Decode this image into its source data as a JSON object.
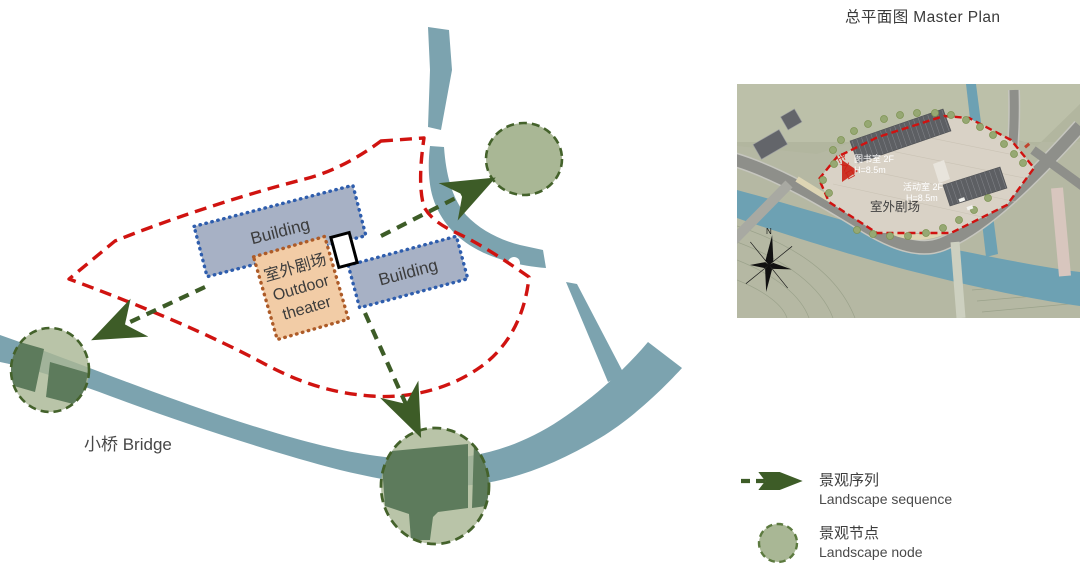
{
  "title": {
    "zh": "总平面图",
    "en": "Master Plan",
    "full": "总平面图 Master Plan"
  },
  "diagram": {
    "building1_label": "Building",
    "building2_label": "Building",
    "theater": {
      "zh": "室外剧场",
      "en_line1": "Outdoor",
      "en_line2": "theater"
    },
    "bridge_label": "小桥 Bridge"
  },
  "master_plan": {
    "labels": {
      "library_name": "图书室 2F",
      "library_height": "H=8.5m",
      "activity_name": "活动室 2F",
      "activity_height": "H=8.5m",
      "outdoor_theater": "室外剧场",
      "main_entrance": "主入口",
      "north": "N"
    }
  },
  "legend": {
    "items": [
      {
        "zh": "景观序列",
        "en": "Landscape sequence",
        "swatch": "dashed-arrow"
      },
      {
        "zh": "景观节点",
        "en": "Landscape node",
        "swatch": "node-circle"
      }
    ]
  },
  "colors": {
    "water": "#7ca3af",
    "plan_water": "#6da1b3",
    "node_fill": "#a9b795",
    "node_inner": "#5d7b5c",
    "node_border": "#44622b",
    "arrow_green": "#3d5c27",
    "boundary_red": "#d01310",
    "building_fill": "#a7b1c5",
    "building_border": "#2e5dad",
    "theater_fill": "#f2cca6",
    "theater_border": "#ad5b28",
    "plan_ground": "#b5b8a3",
    "plaza": "#d9d2c6",
    "text": "#3d3d3d"
  }
}
